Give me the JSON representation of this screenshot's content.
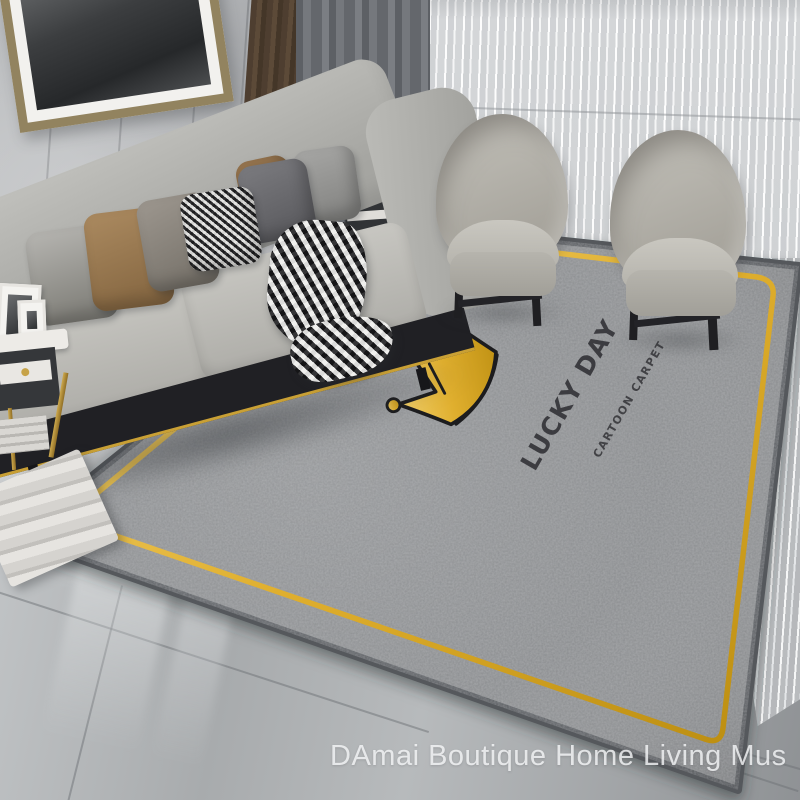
{
  "carpet": {
    "brand_text": "LUCKY DAY",
    "sub_text": "CARTOON CARPET",
    "motif": "crown",
    "colors": {
      "base": "#8a8c8e",
      "edge": "#54585c",
      "gold": "#e0af2e",
      "text": "#2c2c30"
    }
  },
  "watermark": {
    "text": "DAmai Boutique Home Living Mus",
    "color": "#f7f8f9"
  },
  "palette": {
    "wall": "#b6b8ba",
    "floor": "#a9acae",
    "curtain_dark": "#65686d",
    "curtain_sheer": "#d6d8da",
    "sofa": "#b3b3af",
    "sofa_base": "#202024",
    "sofa_gold_trim": "#c9a035",
    "chair": "#b5b3ac",
    "pillow_tan": "#a8855c",
    "pillow_dark": "#6a6a6e",
    "lamp_shade": "#f0eee8",
    "frame_bronze": "#92835f"
  }
}
